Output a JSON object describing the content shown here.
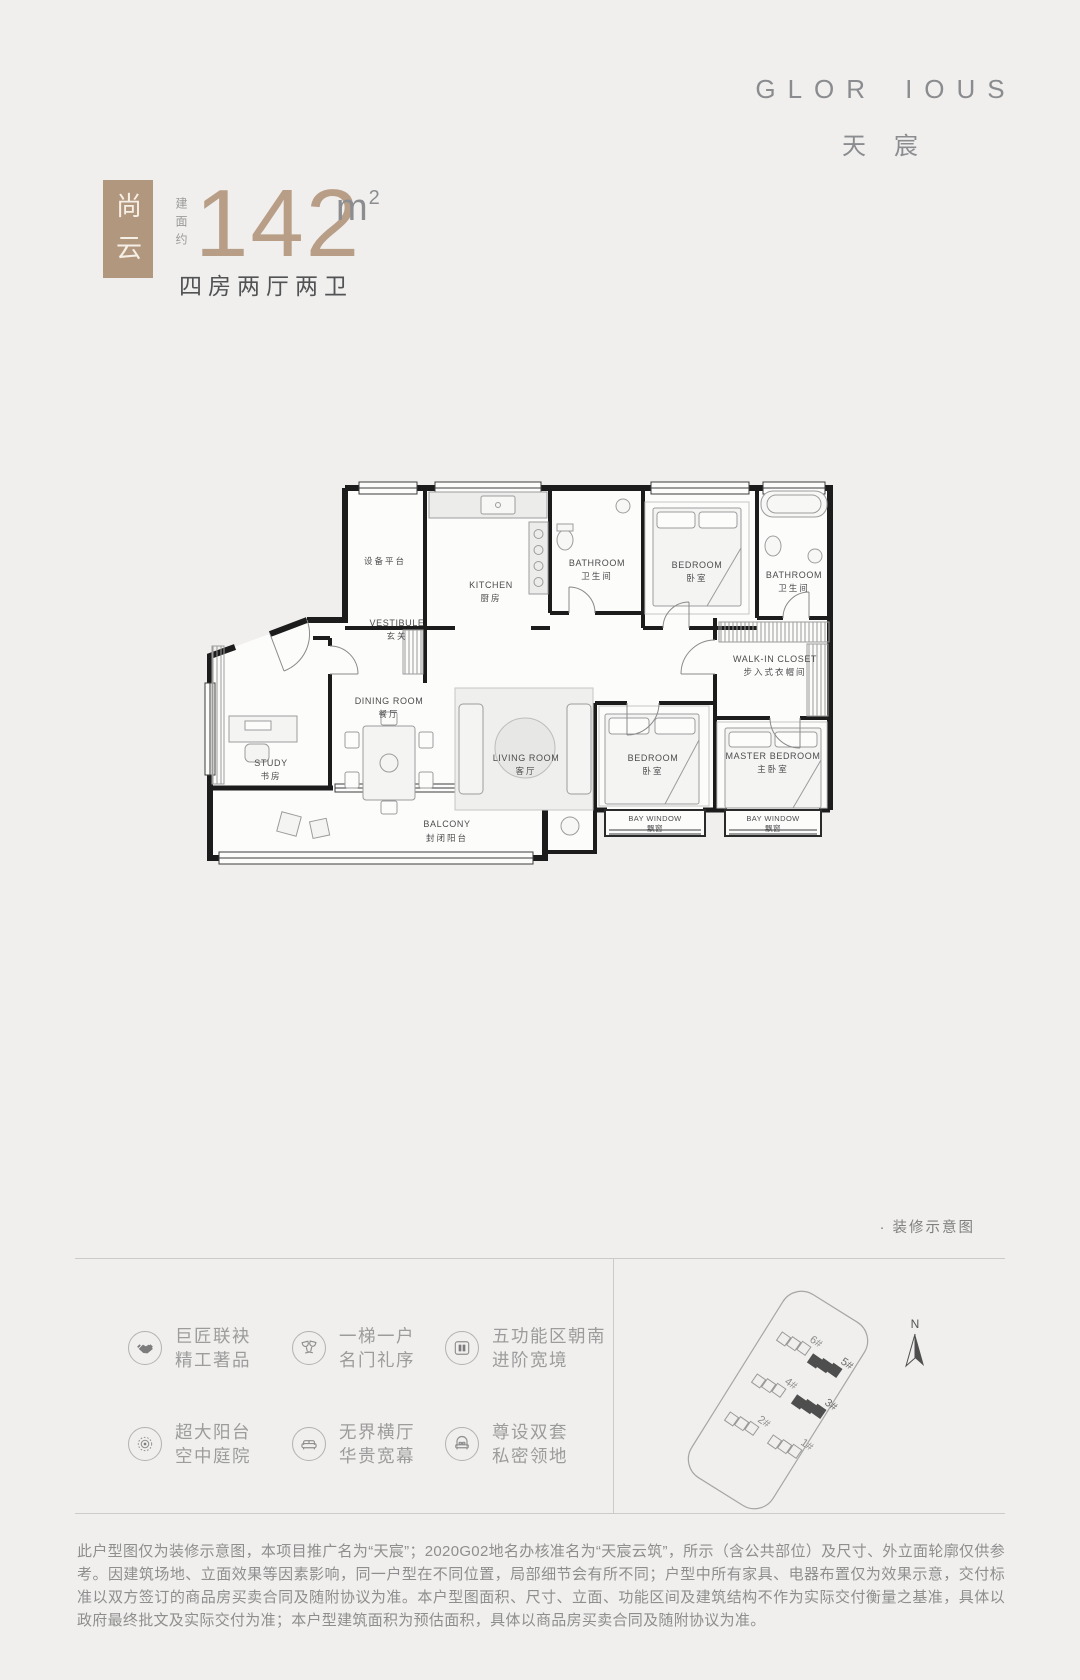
{
  "brand": {
    "name_left": "GLOR",
    "name_right": "IOUS",
    "subtitle": "天宸"
  },
  "unit": {
    "badge": "尚云",
    "area_prefix": "建面约",
    "area_value": "142",
    "area_unit": "m",
    "area_unit_sup": "2",
    "layout_desc": "四房两厅两卫"
  },
  "floorplan": {
    "note": "· 装修示意图",
    "rooms": [
      {
        "id": "equipment-platform",
        "en": "",
        "cn": "设备平台"
      },
      {
        "id": "vestibule",
        "en": "VESTIBULE",
        "cn": "玄关"
      },
      {
        "id": "kitchen",
        "en": "KITCHEN",
        "cn": "厨房"
      },
      {
        "id": "bathroom-1",
        "en": "BATHROOM",
        "cn": "卫生间"
      },
      {
        "id": "bedroom-north",
        "en": "BEDROOM",
        "cn": "卧室"
      },
      {
        "id": "bathroom-2",
        "en": "BATHROOM",
        "cn": "卫生间"
      },
      {
        "id": "walk-in-closet",
        "en": "WALK-IN CLOSET",
        "cn": "步入式衣帽间"
      },
      {
        "id": "study",
        "en": "STUDY",
        "cn": "书房"
      },
      {
        "id": "dining-room",
        "en": "DINING ROOM",
        "cn": "餐厅"
      },
      {
        "id": "living-room",
        "en": "LIVING ROOM",
        "cn": "客厅"
      },
      {
        "id": "bedroom-south",
        "en": "BEDROOM",
        "cn": "卧室"
      },
      {
        "id": "master-bedroom",
        "en": "MASTER BEDROOM",
        "cn": "主卧室"
      },
      {
        "id": "bay-window-1",
        "en": "BAY WINDOW",
        "cn": "飘窗"
      },
      {
        "id": "bay-window-2",
        "en": "BAY WINDOW",
        "cn": "飘窗"
      },
      {
        "id": "balcony",
        "en": "BALCONY",
        "cn": "封闭阳台"
      }
    ]
  },
  "features": {
    "items": [
      {
        "icon": "handshake-icon",
        "line1": "巨匠联袂",
        "line2": "精工著品"
      },
      {
        "icon": "goblet-icon",
        "line1": "一梯一户",
        "line2": "名门礼序"
      },
      {
        "icon": "double-door-icon",
        "line1": "五功能区朝南",
        "line2": "进阶宽境"
      },
      {
        "icon": "sun-icon",
        "line1": "超大阳台",
        "line2": "空中庭院"
      },
      {
        "icon": "sofa-icon",
        "line1": "无界横厅",
        "line2": "华贵宽幕"
      },
      {
        "icon": "bed-icon",
        "line1": "尊设双套",
        "line2": "私密领地"
      }
    ]
  },
  "siteplan": {
    "compass": "N",
    "buildings": [
      {
        "label": "6#",
        "highlighted": false
      },
      {
        "label": "5#",
        "highlighted": true
      },
      {
        "label": "4#",
        "highlighted": false
      },
      {
        "label": "3#",
        "highlighted": true
      },
      {
        "label": "2#",
        "highlighted": false
      },
      {
        "label": "1#",
        "highlighted": false
      }
    ]
  },
  "disclaimer": "此户型图仅为装修示意图，本项目推广名为“天宸”；2020G02地名办核准名为“天宸云筑”，所示（含公共部位）及尺寸、外立面轮廓仅供参考。因建筑场地、立面效果等因素影响，同一户型在不同位置，局部细节会有所不同；户型中所有家具、电器布置仅为效果示意，交付标准以双方签订的商品房买卖合同及随附协议为准。本户型图面积、尺寸、立面、功能区间及建筑结构不作为实际交付衡量之基准，具体以政府最终批文及实际交付为准；本户型建筑面积为预估面积，具体以商品房买卖合同及随附协议为准。",
  "colors": {
    "accent_tan": "#b2977f",
    "number_tan": "#b89e87",
    "page_bg": "#f0efed",
    "text_dark": "#525355",
    "text_gray": "#9c9c9c",
    "wall_black": "#1c1c1c",
    "highlight_building": "#4e4e4e"
  }
}
